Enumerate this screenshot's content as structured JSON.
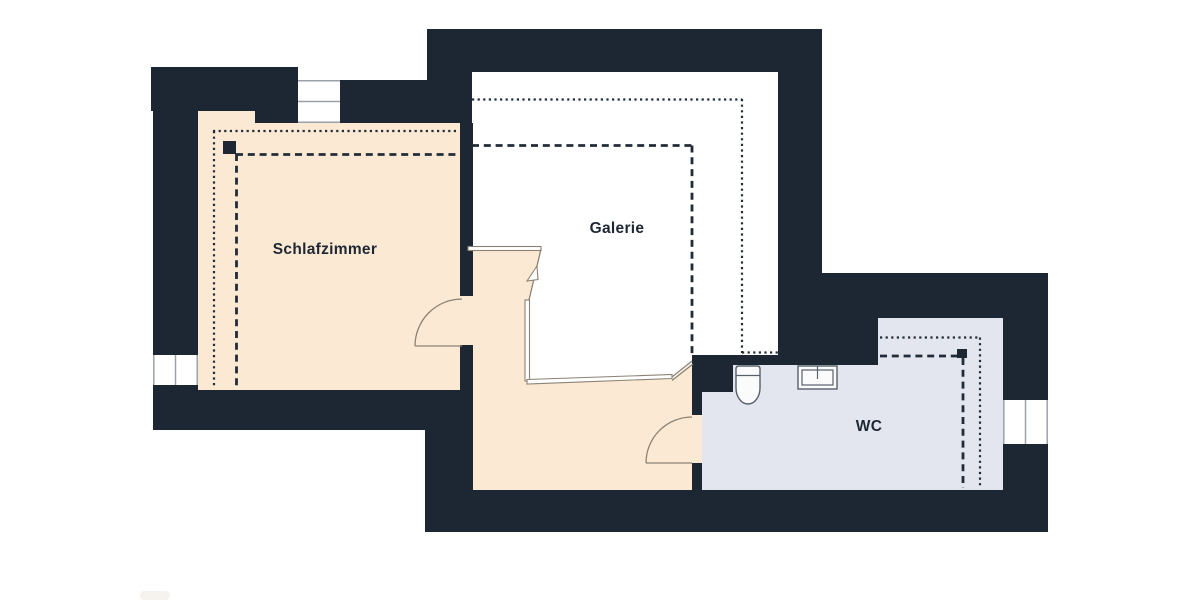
{
  "floor_plan": {
    "rooms": {
      "schlafzimmer": {
        "label": "Schlafzimmer",
        "fill": "#fbe9d4"
      },
      "galerie": {
        "label": "Galerie",
        "fill": "#ffffff"
      },
      "wc": {
        "label": "WC",
        "fill": "#e3e6ee"
      },
      "hallway": {
        "fill": "#fbe9d4"
      }
    },
    "colors": {
      "wall": "#1d2734",
      "thin_line": "#8a8375",
      "window_frame": "#9aa1a9",
      "fixture_outline": "#57606b",
      "guide_line": "#222c39",
      "label": "#1d2734",
      "background": "#ffffff"
    },
    "symbols": {
      "toilet": "toilet",
      "sink": "sink",
      "stairs": "stair-railing-with-break-arrow",
      "markers": "ceiling-height-corner-markers",
      "guides": "dotted-and-dashed-ceiling-height-lines"
    }
  }
}
